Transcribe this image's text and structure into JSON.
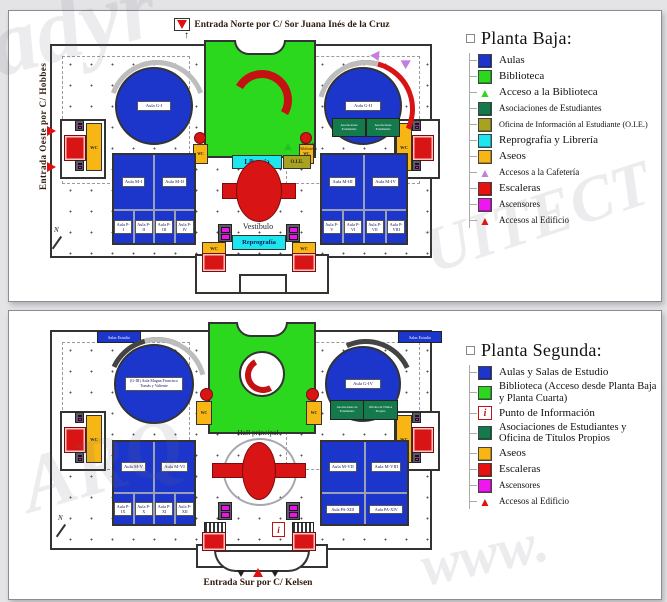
{
  "watermark": {
    "w1": "adyr",
    "w2": "UITECT",
    "w3": "www.",
    "w4": "ARQ"
  },
  "legend_baja": {
    "title": "Planta Baja:",
    "items": [
      {
        "type": "square",
        "color": "#1c36cc",
        "label": "Aulas"
      },
      {
        "type": "square",
        "color": "#2bd81e",
        "label": "Biblioteca"
      },
      {
        "type": "triangle",
        "color": "#2bd81e",
        "label": "Acceso a la Biblioteca"
      },
      {
        "type": "square",
        "color": "#14794b",
        "label": "Asociaciones de Estudiantes"
      },
      {
        "type": "square",
        "color": "#a8a31e",
        "label": "Oficina de Información al Estudiante (O.I.E.)"
      },
      {
        "type": "square",
        "color": "#1ee6ee",
        "label": "Reprografía y Librería"
      },
      {
        "type": "square",
        "color": "#f7b613",
        "label": "Aseos"
      },
      {
        "type": "triangle",
        "color": "#c27fe0",
        "label": "Accesos a la Cafetería"
      },
      {
        "type": "square",
        "color": "#e61212",
        "label": "Escaleras"
      },
      {
        "type": "square",
        "color": "#ef16ef",
        "label": "Ascensores"
      },
      {
        "type": "triangle",
        "color": "#e61212",
        "label": "Accesos al Edificio"
      }
    ]
  },
  "legend_segunda": {
    "title": "Planta Segunda:",
    "items": [
      {
        "type": "square",
        "color": "#1c36cc",
        "label": "Aulas y Salas de Estudio"
      },
      {
        "type": "square",
        "color": "#2bd81e",
        "label": "Biblioteca (Acceso desde Planta Baja y Planta Cuarta)"
      },
      {
        "type": "info",
        "color": "#c41111",
        "label": "Punto de Información"
      },
      {
        "type": "square",
        "color": "#14794b",
        "label": "Asociaciones de Estudiantes y Oficina de Títulos Propios"
      },
      {
        "type": "square",
        "color": "#f7b613",
        "label": "Aseos"
      },
      {
        "type": "square",
        "color": "#e61212",
        "label": "Escaleras"
      },
      {
        "type": "square",
        "color": "#ef16ef",
        "label": "Ascensores"
      },
      {
        "type": "triangle",
        "color": "#e61212",
        "label": "Accesos al Edificio"
      }
    ]
  },
  "plan_baja": {
    "entrance_north": "Entrada Norte por C/ Sor Juana Inés de la Cruz",
    "entrance_west": "Entrada Oeste por C/ Hobbes",
    "rooms": {
      "g1": "Aula G-I",
      "g2": "Aula G-II",
      "m1": "Aula M-I",
      "m2": "Aula M-II",
      "m3": "Aula M-III",
      "m4": "Aula M-IV",
      "p1": "Aula P-I",
      "p2": "Aula P-II",
      "p3": "Aula P-III",
      "p4": "Aula P-IV",
      "p5": "Aula P-V",
      "p6": "Aula P-VI",
      "p7": "Aula P-VII",
      "p8": "Aula P-VIII",
      "vestibulo": "Vestíbulo",
      "reprografia": "Reprografía",
      "libreria": "Librería",
      "oie": "O.I.E.",
      "entrada_biblioteca": "Entrada Biblioteca",
      "asociaciones": "Asociaciones Estudiantes",
      "wc": "WC",
      "north": "N"
    }
  },
  "plan_segunda": {
    "entrance_south": "Entrada Sur por C/ Kelsen",
    "rooms": {
      "g3": "(G-III) Aula Magna Francisco Tomás y Valiente",
      "g4": "Aula G-IV",
      "m5": "Aula M-V",
      "m6": "Aula M-VI",
      "m7": "Aula M-VII",
      "m8": "Aula M-VIII",
      "p9": "Aula P-IX",
      "p10": "Aula P-X",
      "p11": "Aula P-XI",
      "p12": "Aula P-XII",
      "pa13": "Aula PA-XIII",
      "pa14": "Aula PA-XIV",
      "hall": "Hall principal",
      "salas": "Salas Estudio",
      "asociaciones": "Asociaciones de Estudiantes",
      "titulos": "Oficina de Títulos Propios",
      "info": "i",
      "wc": "WC",
      "north": "N"
    }
  }
}
